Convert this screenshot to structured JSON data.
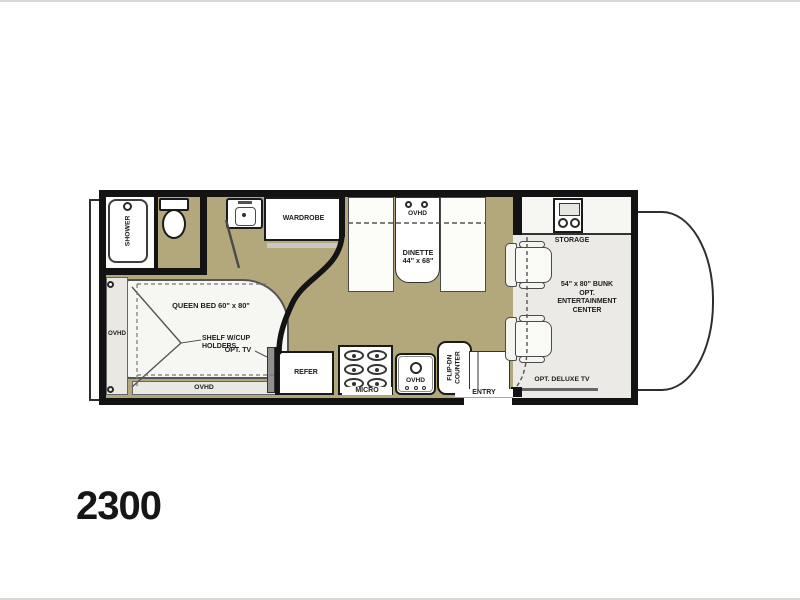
{
  "page": {
    "model_number": "2300"
  },
  "colors": {
    "floor_tan": "#b3a77c",
    "wall_black": "#131313",
    "cab_floor_gray": "#ebeae6",
    "furniture_white": "#ffffff",
    "tv_gray": "#909090"
  },
  "plan": {
    "bath": {
      "shower": "SHOWER"
    },
    "wardrobe": {
      "label": "WARDROBE"
    },
    "bedroom": {
      "bed_label": "QUEEN BED  60\" x 80\"",
      "ovhd_left": "OVHD",
      "ovhd_bottom": "OVHD",
      "shelf_line1": "SHELF W/CUP",
      "shelf_line2": "HOLDERS",
      "opt_tv": "OPT. TV"
    },
    "kitchen": {
      "refer": "REFER",
      "micro": "MICRO",
      "sink_ovhd": "OVHD",
      "flip_counter_line1": "FLIP-DN",
      "flip_counter_line2": "COUNTER",
      "entry": "ENTRY"
    },
    "dinette": {
      "ovhd": "OVHD",
      "line1": "DINETTE",
      "line2": "44\" x 68\""
    },
    "front": {
      "storage": "STORAGE",
      "bunk_lines": [
        "54\" x 80\" BUNK",
        "OPT.",
        "ENTERTAINMENT",
        "CENTER"
      ],
      "opt_deluxe_tv": "OPT. DELUXE TV"
    }
  }
}
